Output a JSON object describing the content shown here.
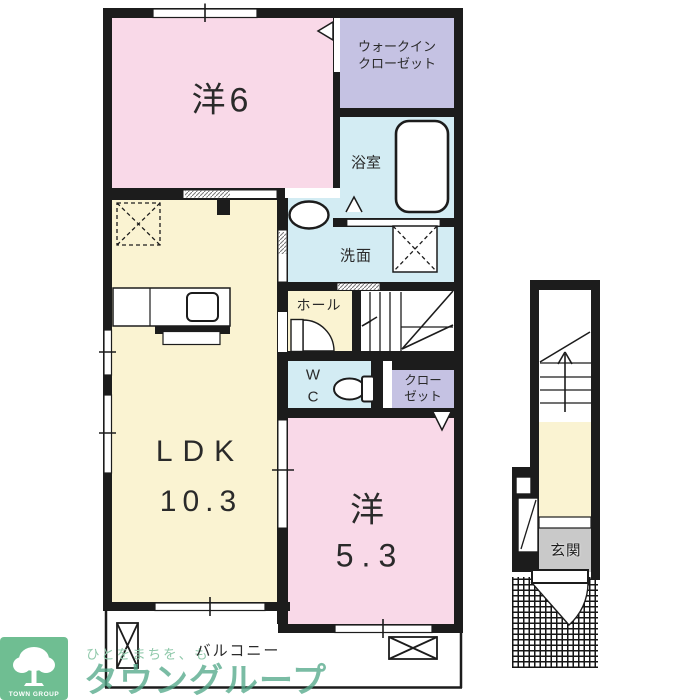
{
  "labels": {
    "yo6": "洋6",
    "wic_line1": "ウォークイン",
    "wic_line2": "クローゼット",
    "bath": "浴室",
    "senmen": "洗面",
    "hall": "ホール",
    "wc_line1": "W",
    "wc_line2": "C",
    "closet_line1": "クロー",
    "closet_line2": "ゼット",
    "ldk_line1": "LDK",
    "ldk_line2": "10.3",
    "yo53_line1": "洋",
    "yo53_line2": "5.3",
    "balcony": "バルコニー",
    "genkan": "玄関"
  },
  "watermark": {
    "tagline": "ひとをまちを、も",
    "brand": "タウングループ",
    "logo_text": "TOWN GROUP"
  },
  "colors": {
    "room_pink": "#f9d9e8",
    "room_purple": "#c5c2e3",
    "room_blue": "#d3ecf3",
    "room_yellow": "#faf3d2",
    "genkan_gray": "#c9c9c9",
    "wall_black": "#1c1c1c",
    "brand_green": "#55a98b",
    "logo_green": "#6fbe92"
  }
}
